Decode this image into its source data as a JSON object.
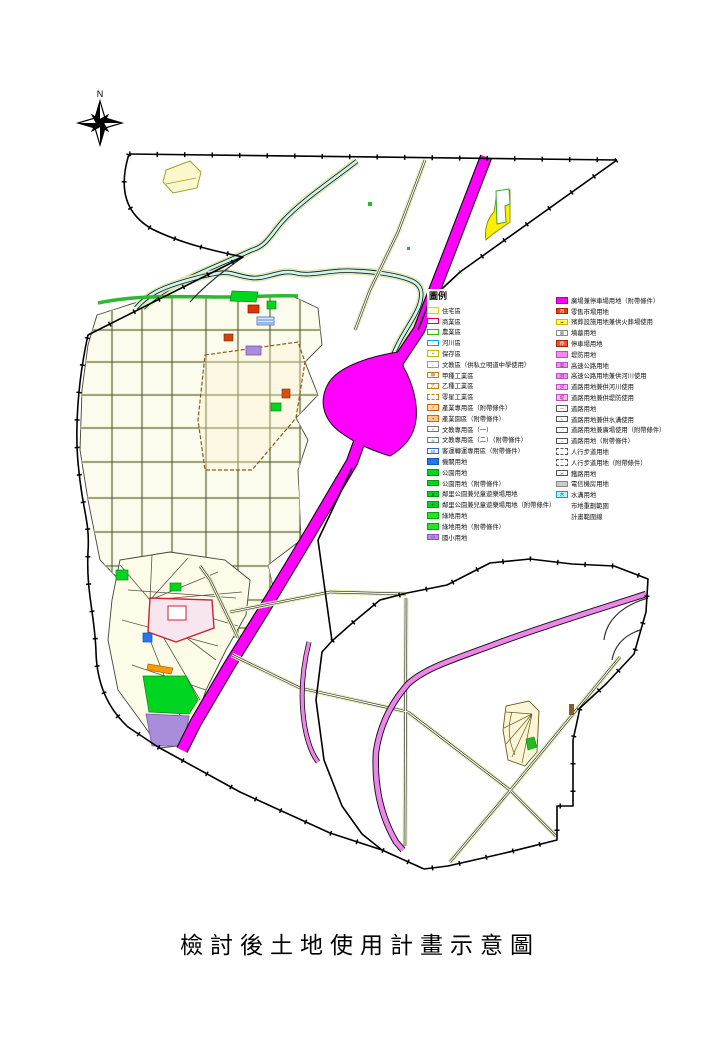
{
  "page": {
    "title_caption": "檢討後土地使用計畫示意圖",
    "compass_label": "N"
  },
  "palette": {
    "magenta": "#ff00ff",
    "pink_road": "#ee85e8",
    "park_green": "#00d622",
    "school_purple": "#a98ddb",
    "river_cyan": "#cdf4f0",
    "yellow_zone": "#ffee00",
    "agency_blue": "#2277ee",
    "market_red": "#e64400",
    "parcel_cream": "#fcfcee"
  },
  "legend": {
    "title": "圖例",
    "left_items": [
      {
        "label": "住宅區",
        "fill": "#ffffc8",
        "border": "#d6d600"
      },
      {
        "label": "商業區",
        "fill": "#ffffff",
        "border": "#e8003c"
      },
      {
        "label": "農業區",
        "fill": "#f6fff2",
        "border": "#33bb00"
      },
      {
        "label": "河川區",
        "fill": "#ffffff",
        "border": "#00aadd"
      },
      {
        "label": "保存區",
        "fill": "#ffffff",
        "border": "#c8b400",
        "mark": "•",
        "markColor": "#7a5a00"
      },
      {
        "label": "文教區（供私立明道中學使用）",
        "fill": "#ffffff",
        "border": "#999999",
        "mark": "∶∶",
        "markColor": "#b455d4"
      },
      {
        "label": "甲種工業區",
        "fill": "#fff8ee",
        "border": "#b8860b",
        "mark": "甲",
        "markColor": "#8a5a1a"
      },
      {
        "label": "乙種工業區",
        "fill": "#fff8ee",
        "border": "#b8860b",
        "mark": "乙",
        "markColor": "#8a5a1a"
      },
      {
        "label": "零星工業區",
        "fill": "#ffffff",
        "border": "#b8860b",
        "dashed": true
      },
      {
        "label": "產業專用區（附帶條件）",
        "fill": "#ffdcb0",
        "border": "#cc6600",
        "mark": "∕∕",
        "markColor": "#cc6600"
      },
      {
        "label": "產業園區（附帶條件）",
        "fill": "#ffcc88",
        "border": "#cc6600",
        "mark": "▪",
        "markColor": "#884400"
      },
      {
        "label": "文教專用區（一）",
        "fill": "#ffffff",
        "border": "#777777",
        "mark": "+",
        "markColor": "#555555"
      },
      {
        "label": "文教專用區（二）（附帶條件）",
        "fill": "#ffffff",
        "border": "#777777",
        "mark": "※",
        "markColor": "#44aa44"
      },
      {
        "label": "客運轉運專用區（附帶條件）",
        "fill": "#ffffff",
        "border": "#3366cc",
        "mark": "M",
        "markColor": "#2255cc"
      },
      {
        "label": "機關用地",
        "fill": "#2277ee",
        "border": "#1155bb"
      },
      {
        "label": "公園用地",
        "fill": "#00d622",
        "border": "#009911"
      },
      {
        "label": "公園用地（附帶條件）",
        "fill": "#00d622",
        "border": "#009911",
        "mark": "·",
        "markColor": "#004400"
      },
      {
        "label": "鄰里公園兼兒童遊樂場用地",
        "fill": "#00d622",
        "border": "#009911",
        "mark": "∗",
        "markColor": "#004400"
      },
      {
        "label": "鄰里公園兼兒童遊樂場用地（附帶條件）",
        "fill": "#00d622",
        "border": "#009911",
        "mark": "∗·",
        "markColor": "#004400"
      },
      {
        "label": "綠地用地",
        "fill": "#22e622",
        "border": "#00aa00"
      },
      {
        "label": "綠地用地（附帶條件）",
        "fill": "#22e622",
        "border": "#00aa00",
        "mark": "·",
        "markColor": "#004400"
      },
      {
        "label": "國小用地",
        "fill": "#bb8ce8",
        "border": "#8855bb",
        "mark": "小",
        "markColor": "#553388"
      }
    ],
    "right_items": [
      {
        "label": "廣場兼停車場用地（附帶條件）",
        "fill": "#ff00ff",
        "border": "#aa00aa"
      },
      {
        "label": "零售市場用地",
        "fill": "#e64400",
        "border": "#aa2200",
        "mark": "市",
        "markColor": "#ffffff"
      },
      {
        "label": "殯葬設施用地兼供火葬場使用",
        "fill": "#ffff55",
        "border": "#bbbb00",
        "mark": "••",
        "markColor": "#cc0000"
      },
      {
        "label": "墳墓用地",
        "fill": "#ffffff",
        "border": "#888888",
        "mark": "墓",
        "markColor": "#555555"
      },
      {
        "label": "停車場用地",
        "fill": "#ee5533",
        "border": "#aa2200",
        "mark": "停",
        "markColor": "#ffffff"
      },
      {
        "label": "堤防用地",
        "fill": "#f48cf0",
        "border": "#c050c0"
      },
      {
        "label": "高速公路用地",
        "fill": "#f48cf0",
        "border": "#c050c0",
        "mark": "高",
        "markColor": "#882288"
      },
      {
        "label": "高速公路用地兼供河川使用",
        "fill": "#f48cf0",
        "border": "#c050c0",
        "mark": "河",
        "markColor": "#882288"
      },
      {
        "label": "道路用地兼供河川使用",
        "fill": "#f8b4f4",
        "border": "#c050c0",
        "mark": "河",
        "markColor": "#882288"
      },
      {
        "label": "道路用地兼供堤防使用",
        "fill": "#f8b4f4",
        "border": "#c050c0",
        "mark": "堤",
        "markColor": "#882288"
      },
      {
        "label": "道路用地",
        "fill": "#ffffff",
        "border": "#555555",
        "mark": "—",
        "markColor": "#555555"
      },
      {
        "label": "道路用地兼供水溝使用",
        "fill": "#ffffff",
        "border": "#555555",
        "mark": "≈",
        "markColor": "#00aacc"
      },
      {
        "label": "道路用地兼廣場使用（附帶條件）",
        "fill": "#ffffff",
        "border": "#555555",
        "mark": "·¨",
        "markColor": "#555555"
      },
      {
        "label": "道路用地（附帶條件）",
        "fill": "#ffffff",
        "border": "#555555",
        "mark": "–",
        "markColor": "#555555"
      },
      {
        "label": "人行步道用地",
        "fill": "#ffffff",
        "border": "#555555",
        "dashed": true
      },
      {
        "label": "人行步道用地（附帶條件）",
        "fill": "#ffffff",
        "border": "#555555",
        "dashed": true,
        "mark": "·",
        "markColor": "#555555"
      },
      {
        "label": "鐵路用地",
        "fill": "#ffffff",
        "border": "#555555",
        "mark": "≍",
        "markColor": "#333333"
      },
      {
        "label": "電信機房用地",
        "fill": "#cccccc",
        "border": "#888888"
      },
      {
        "label": "水溝用地",
        "fill": "#bbf4f4",
        "border": "#00a8b8",
        "mark": "水",
        "markColor": "#006677"
      },
      {
        "label": "市地重劃範圍",
        "type": "line-dash"
      },
      {
        "label": "計畫範圍線",
        "type": "line-dashdot"
      }
    ]
  }
}
